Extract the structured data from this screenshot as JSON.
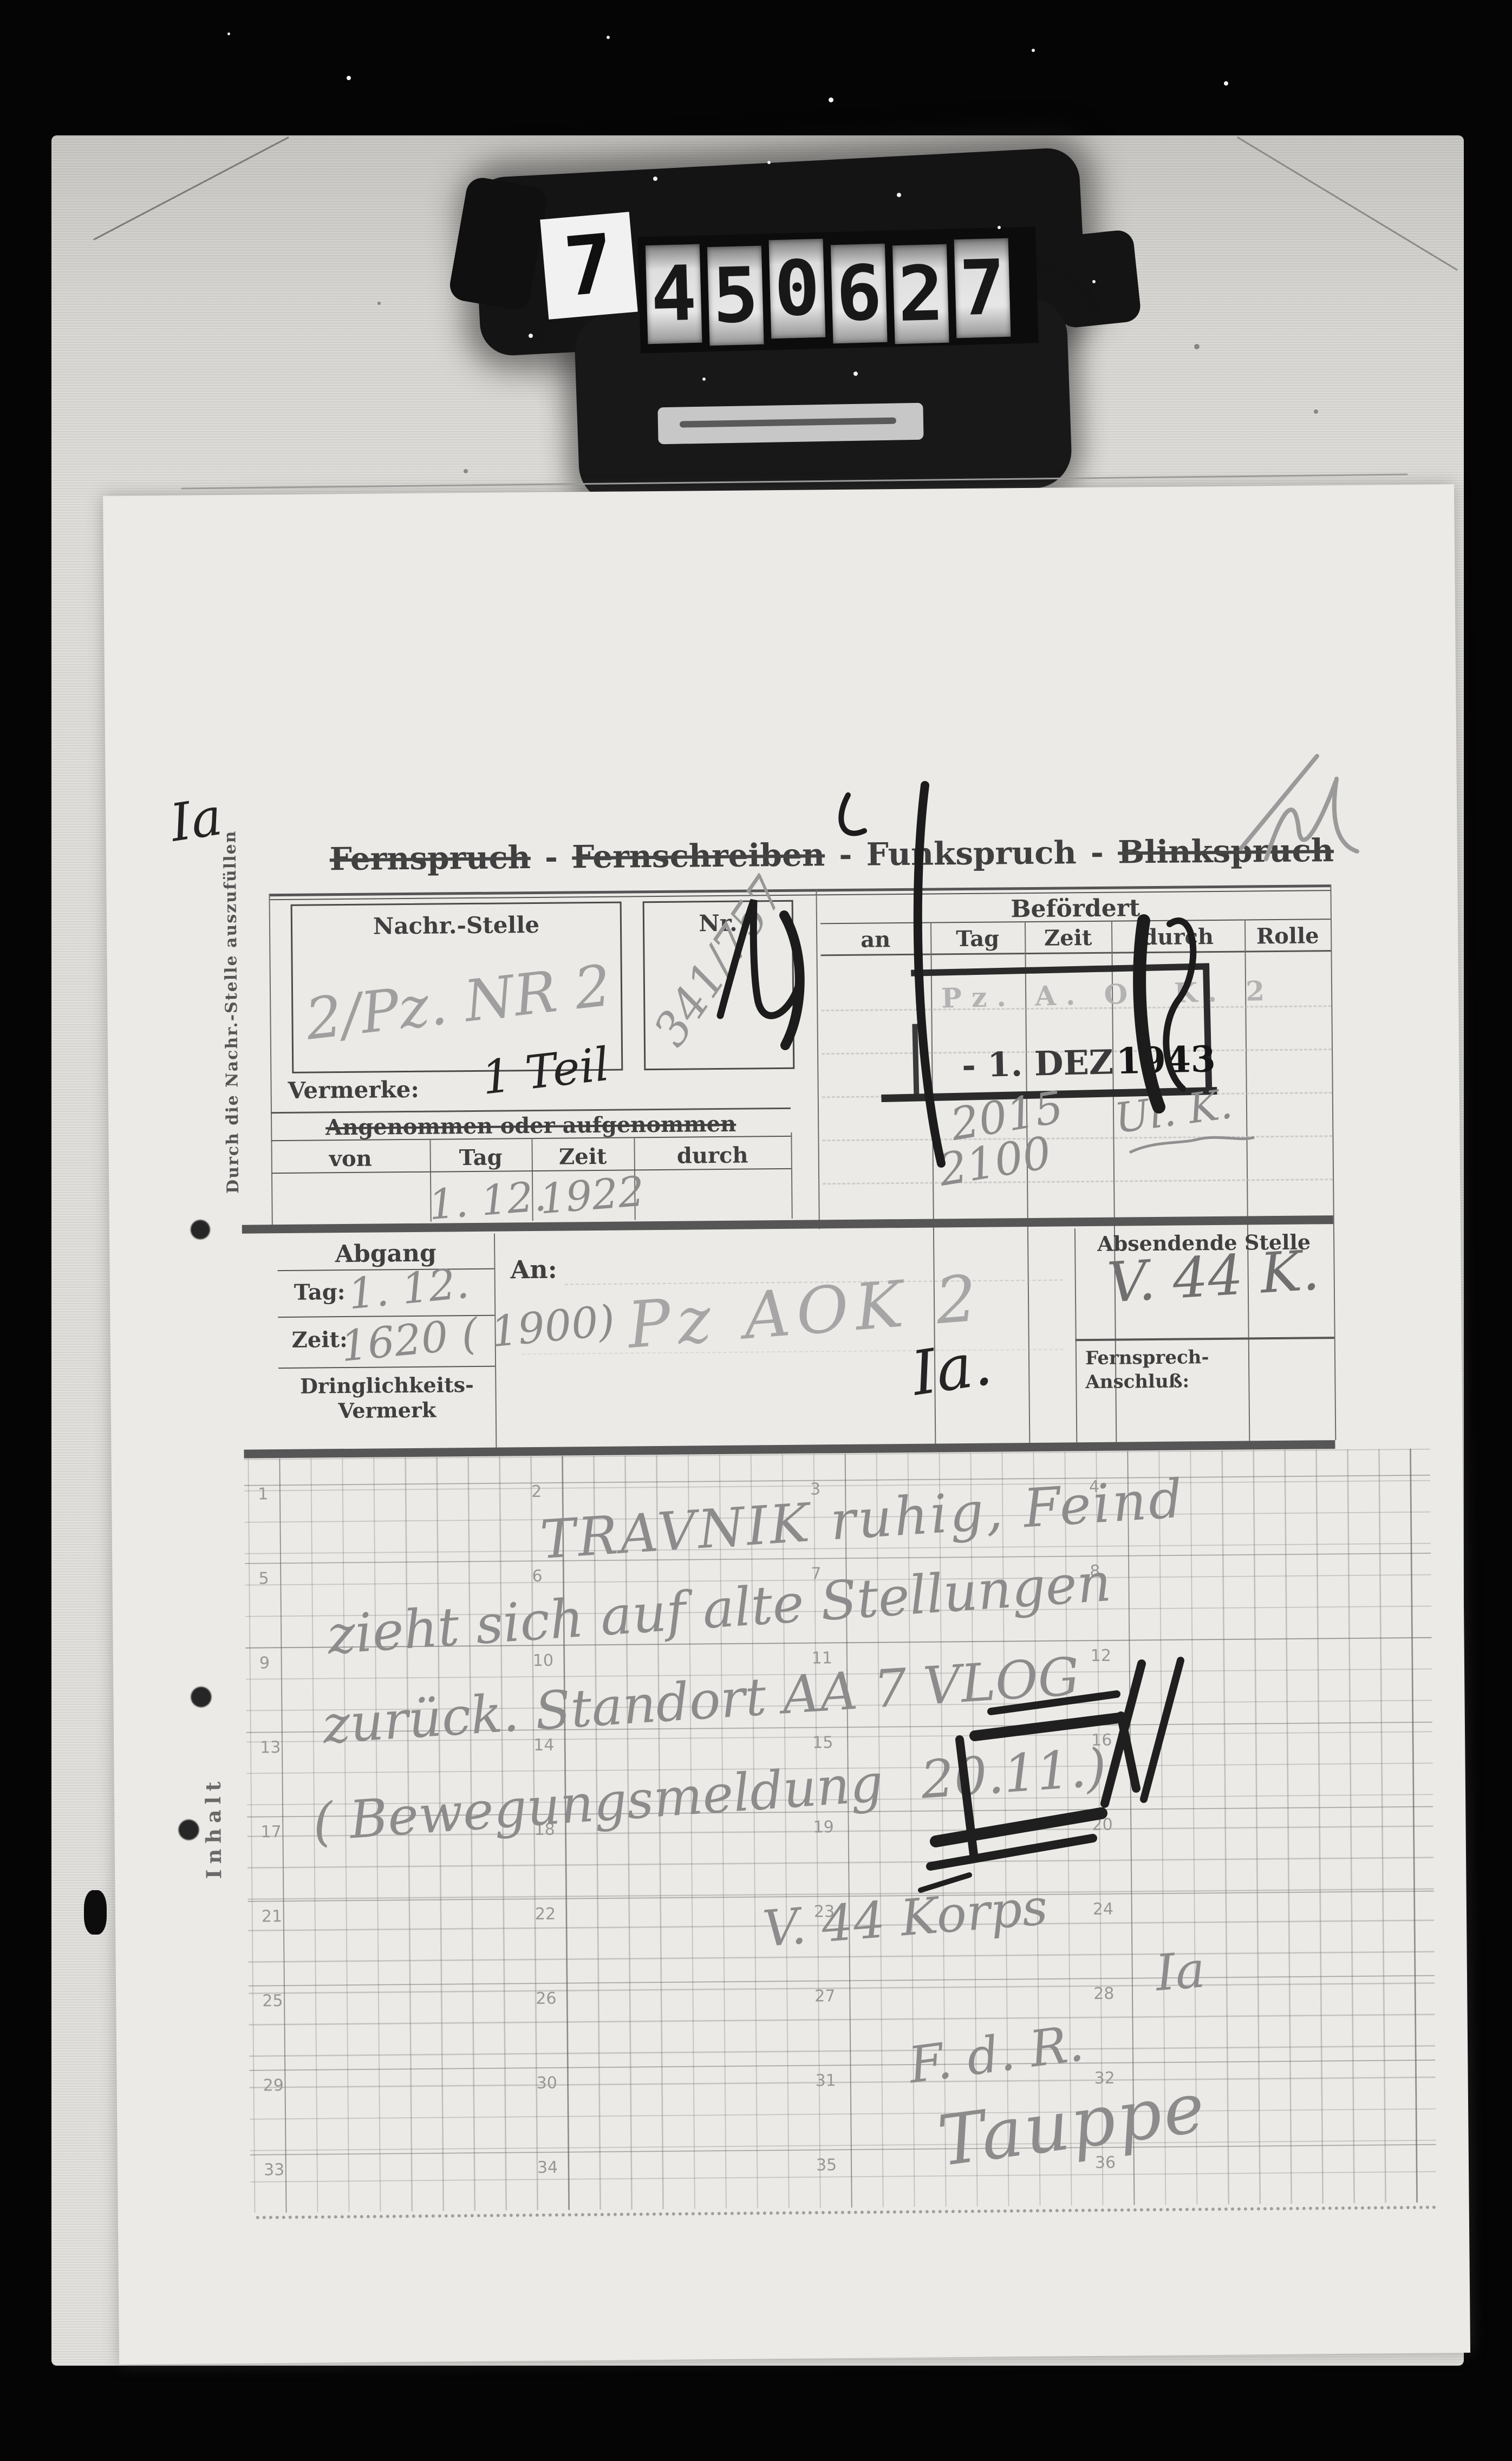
{
  "film_counter": {
    "prefix_digit": "7",
    "wheel_digits": [
      "4",
      "5",
      "0",
      "6",
      "2",
      "7"
    ]
  },
  "form": {
    "title_words": [
      {
        "label": "Fernspruch",
        "struck": true
      },
      {
        "label": "Fernschreiben",
        "struck": true
      },
      {
        "label": "Funkspruch",
        "struck": false
      },
      {
        "label": "Blinkspruch",
        "struck": true
      }
    ],
    "title_separator": "-",
    "margin_note": "Durch die Nachr.-Stelle auszufüllen",
    "inhalt_label": "Inhalt",
    "nachr_stelle_label": "Nachr.-Stelle",
    "nr_label": "Nr.",
    "vermerke_label": "Vermerke:",
    "angenommen_title": "Angenommen oder aufgenommen",
    "angenommen_columns": [
      "von",
      "Tag",
      "Zeit",
      "durch"
    ],
    "befoerdert_title": "Befördert",
    "befoerdert_columns": [
      "an",
      "Tag",
      "Zeit",
      "durch",
      "Rolle"
    ],
    "abgang_title": "Abgang",
    "tag_label": "Tag:",
    "zeit_label": "Zeit:",
    "dringlichkeit_line_1": "Dringlichkeits-",
    "dringlichkeit_line_2": "Vermerk",
    "an_label": "An:",
    "absendende_label": "Absendende Stelle",
    "fernsprech_line_1": "Fernsprech-",
    "fernsprech_line_2": "Anschluß:",
    "grid_numbers": [
      "1",
      "2",
      "3",
      "4",
      "5",
      "6",
      "7",
      "8",
      "9",
      "10",
      "11",
      "12",
      "13",
      "14",
      "15",
      "16",
      "17",
      "18",
      "19",
      "20",
      "21",
      "22",
      "23",
      "24",
      "25",
      "26",
      "27",
      "28",
      "29",
      "30",
      "31",
      "32",
      "33",
      "34",
      "35",
      "36"
    ]
  },
  "stamp": {
    "unit_line": "Pz. A. O. K. 2",
    "date": "- 1. DEZ",
    "year": "1943"
  },
  "handwriting": {
    "corner_note": "Ia",
    "nachr_stelle": "2/Pz. NR 2",
    "nr": "341/757",
    "vermerke": "1 Teil",
    "angenommen_tag": "1. 12.",
    "angenommen_zeit": "1922",
    "abgang_tag": "1. 12.",
    "abgang_zeit": "1620 ( 1900)",
    "an_unit": "Pz AOK 2",
    "an_section": "Ia.",
    "absender": "V. 44 K.",
    "befoerdert_zeit_1": "2015",
    "befoerdert_zeit_2": "2100",
    "befoerdert_durch": "Ul. K.",
    "message_line_1": "TRAVNIK ruhig, Feind",
    "message_line_2": "zieht sich auf alte Stellungen",
    "message_line_3": "zurück. Standort AA 7 VLOG",
    "message_line_4": "( Bewegungsmeldung",
    "message_line_4_boxed": "20.11.)",
    "signature_unit": "V. 44 Korps",
    "signature_section": "Ia",
    "signature_fdr": "F. d. R.",
    "signature_name": "Tauppe"
  }
}
